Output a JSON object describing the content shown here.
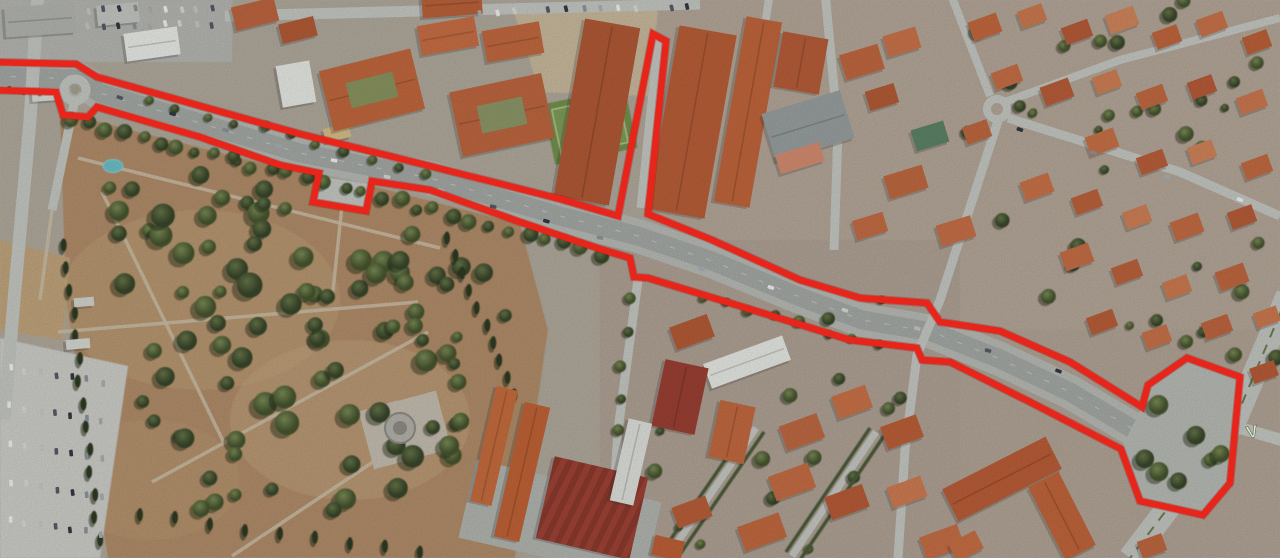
{
  "map": {
    "view": "satellite-aerial",
    "road_marking_label": "V"
  },
  "overlay": {
    "route_outline_color": "#e8251b",
    "route_outline_underlay": "#8a1410",
    "route_outline_width": 6.5,
    "route_points": [
      [
        -8,
        62
      ],
      [
        76,
        64
      ],
      [
        97,
        77
      ],
      [
        300,
        134
      ],
      [
        430,
        166
      ],
      [
        560,
        199
      ],
      [
        618,
        216
      ],
      [
        653,
        34
      ],
      [
        666,
        41
      ],
      [
        648,
        214
      ],
      [
        712,
        240
      ],
      [
        800,
        280
      ],
      [
        860,
        298
      ],
      [
        927,
        303
      ],
      [
        940,
        322
      ],
      [
        1000,
        331
      ],
      [
        1070,
        362
      ],
      [
        1142,
        407
      ],
      [
        1148,
        385
      ],
      [
        1187,
        358
      ],
      [
        1240,
        377
      ],
      [
        1230,
        483
      ],
      [
        1203,
        515
      ],
      [
        1140,
        501
      ],
      [
        1121,
        449
      ],
      [
        1030,
        402
      ],
      [
        950,
        362
      ],
      [
        922,
        360
      ],
      [
        917,
        348
      ],
      [
        850,
        340
      ],
      [
        730,
        303
      ],
      [
        648,
        278
      ],
      [
        634,
        277
      ],
      [
        630,
        258
      ],
      [
        600,
        249
      ],
      [
        520,
        222
      ],
      [
        430,
        190
      ],
      [
        372,
        181
      ],
      [
        366,
        211
      ],
      [
        313,
        202
      ],
      [
        319,
        173
      ],
      [
        280,
        165
      ],
      [
        200,
        137
      ],
      [
        97,
        107
      ],
      [
        88,
        117
      ],
      [
        63,
        115
      ],
      [
        56,
        92
      ],
      [
        -8,
        90
      ]
    ]
  }
}
